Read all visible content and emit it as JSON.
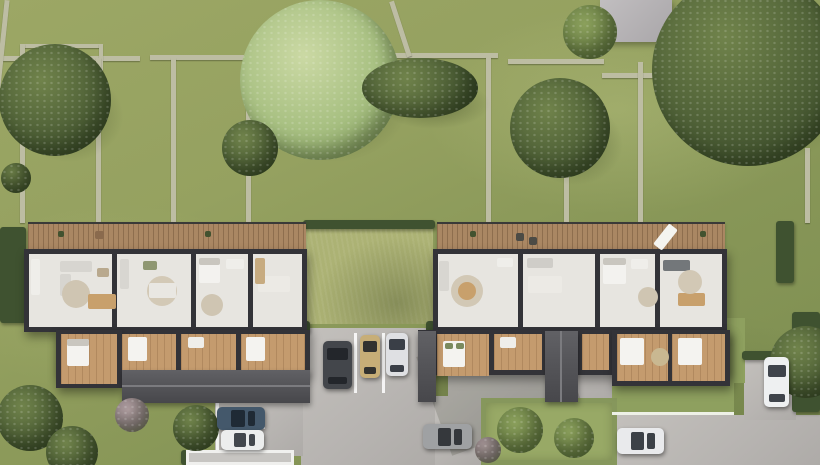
{
  "scene": {
    "canvas": {
      "width": 820,
      "height": 465
    },
    "palette": {
      "grass_base": "#8d9c5e",
      "grass_light": "#a3af6c",
      "courtyard_grass": "#acb274",
      "stone_wall": "#bdbda3",
      "hedge_dark": "#3f5230",
      "pavement": "#bab7b4",
      "deck_wood": "#aa8763",
      "building_wall": "#333338",
      "floor_light": "#e7e5e0",
      "floor_wood": "#c49b6e",
      "roof_gray": "#505054",
      "tree_dark": "#4a5c33",
      "tree_light": "#a9c183",
      "bed_white": "#f4f3f0",
      "table_tan": "#c8a06c"
    },
    "walls": [
      {
        "x": 0,
        "y": 56,
        "w": 140,
        "h": 5
      },
      {
        "x": 150,
        "y": 55,
        "w": 238,
        "h": 5
      },
      {
        "x": 392,
        "y": 53,
        "w": 106,
        "h": 5
      },
      {
        "x": 508,
        "y": 59,
        "w": 96,
        "h": 5
      },
      {
        "x": 602,
        "y": 73,
        "w": 60,
        "h": 5
      },
      {
        "x": 22,
        "y": 44,
        "w": 78,
        "h": 4
      },
      {
        "x": 99,
        "y": 44,
        "w": 4,
        "h": 64
      },
      {
        "x": 20,
        "y": 44,
        "w": 5,
        "h": 179
      },
      {
        "x": 96,
        "y": 58,
        "w": 5,
        "h": 165
      },
      {
        "x": 171,
        "y": 58,
        "w": 5,
        "h": 165
      },
      {
        "x": 246,
        "y": 58,
        "w": 5,
        "h": 165
      },
      {
        "x": 486,
        "y": 57,
        "w": 5,
        "h": 166
      },
      {
        "x": 564,
        "y": 108,
        "w": 5,
        "h": 115
      },
      {
        "x": 638,
        "y": 62,
        "w": 5,
        "h": 161
      },
      {
        "x": 805,
        "y": 148,
        "w": 5,
        "h": 75
      },
      {
        "x": 398,
        "y": 0,
        "w": 5,
        "h": 58,
        "rot": -18
      },
      {
        "x": 0,
        "y": 0,
        "w": 5,
        "h": 88,
        "rot": 6
      }
    ],
    "hedges": [
      {
        "x": 303,
        "y": 220,
        "w": 132,
        "h": 9
      },
      {
        "x": 0,
        "y": 227,
        "w": 26,
        "h": 96
      },
      {
        "x": 776,
        "y": 221,
        "w": 18,
        "h": 62
      },
      {
        "x": 742,
        "y": 351,
        "w": 52,
        "h": 9
      },
      {
        "x": 300,
        "y": 321,
        "w": 10,
        "h": 12
      },
      {
        "x": 426,
        "y": 321,
        "w": 9,
        "h": 12
      },
      {
        "x": 792,
        "y": 312,
        "w": 28,
        "h": 100
      },
      {
        "x": 181,
        "y": 450,
        "w": 7,
        "h": 15
      }
    ],
    "pavements": [
      {
        "x": 301,
        "y": 328,
        "w": 134,
        "h": 137
      },
      {
        "x": 215,
        "y": 401,
        "w": 88,
        "h": 55
      },
      {
        "x": 435,
        "y": 396,
        "w": 48,
        "h": 69
      },
      {
        "x": 448,
        "y": 372,
        "w": 164,
        "h": 28
      },
      {
        "x": 612,
        "y": 415,
        "w": 208,
        "h": 50
      },
      {
        "x": 744,
        "y": 357,
        "w": 52,
        "h": 63
      }
    ],
    "shades": [
      {
        "x": 430,
        "y": 330,
        "w": 140,
        "h": 105,
        "rot": -20
      }
    ],
    "grass_areas": [
      {
        "x": 305,
        "y": 228,
        "w": 128,
        "h": 96,
        "kind": "courtyard"
      },
      {
        "x": 612,
        "y": 383,
        "w": 122,
        "h": 32,
        "kind": "lawn"
      },
      {
        "x": 727,
        "y": 318,
        "w": 18,
        "h": 65,
        "kind": "lawn"
      },
      {
        "x": 481,
        "y": 398,
        "w": 136,
        "h": 67,
        "kind": "plot"
      }
    ],
    "markings": [
      {
        "x": 354,
        "y": 333,
        "w": 3,
        "h": 60
      },
      {
        "x": 382,
        "y": 333,
        "w": 3,
        "h": 60
      },
      {
        "x": 216,
        "y": 402,
        "w": 3,
        "h": 52
      },
      {
        "x": 217,
        "y": 427,
        "w": 48,
        "h": 2
      },
      {
        "x": 612,
        "y": 412,
        "w": 122,
        "h": 3
      }
    ],
    "structures": [
      {
        "x": 600,
        "y": 0,
        "w": 72,
        "h": 42,
        "kind": "flatroof",
        "name": "flat-roof-building"
      },
      {
        "x": 186,
        "y": 450,
        "w": 108,
        "h": 15,
        "kind": "canopy",
        "name": "carport-canopy"
      }
    ],
    "decks": [
      {
        "x": 28,
        "y": 222,
        "w": 278,
        "h": 29
      },
      {
        "x": 437,
        "y": 222,
        "w": 288,
        "h": 29
      }
    ],
    "blocks": [
      {
        "x": 24,
        "y": 249,
        "w": 283,
        "h": 83
      },
      {
        "x": 433,
        "y": 249,
        "w": 294,
        "h": 83
      },
      {
        "x": 56,
        "y": 330,
        "w": 254,
        "h": 45
      },
      {
        "x": 56,
        "y": 330,
        "w": 66,
        "h": 58
      },
      {
        "x": 418,
        "y": 330,
        "w": 312,
        "h": 45
      },
      {
        "x": 612,
        "y": 330,
        "w": 118,
        "h": 56
      }
    ],
    "rooms": [
      {
        "x": 29,
        "y": 254,
        "w": 83,
        "h": 73,
        "f": "light"
      },
      {
        "x": 117,
        "y": 254,
        "w": 74,
        "h": 73,
        "f": "light"
      },
      {
        "x": 196,
        "y": 254,
        "w": 52,
        "h": 73,
        "f": "light"
      },
      {
        "x": 253,
        "y": 254,
        "w": 49,
        "h": 73,
        "f": "light"
      },
      {
        "x": 438,
        "y": 254,
        "w": 80,
        "h": 73,
        "f": "light"
      },
      {
        "x": 523,
        "y": 254,
        "w": 72,
        "h": 73,
        "f": "light"
      },
      {
        "x": 600,
        "y": 254,
        "w": 55,
        "h": 73,
        "f": "light"
      },
      {
        "x": 660,
        "y": 254,
        "w": 62,
        "h": 73,
        "f": "light"
      },
      {
        "x": 61,
        "y": 334,
        "w": 56,
        "h": 50,
        "f": "wood"
      },
      {
        "x": 122,
        "y": 334,
        "w": 54,
        "h": 36,
        "f": "wood"
      },
      {
        "x": 181,
        "y": 334,
        "w": 55,
        "h": 36,
        "f": "wood"
      },
      {
        "x": 241,
        "y": 334,
        "w": 64,
        "h": 36,
        "f": "wood"
      },
      {
        "x": 437,
        "y": 334,
        "w": 52,
        "h": 42,
        "f": "wood"
      },
      {
        "x": 494,
        "y": 334,
        "w": 48,
        "h": 36,
        "f": "wood"
      },
      {
        "x": 582,
        "y": 334,
        "w": 27,
        "h": 36,
        "f": "wood"
      },
      {
        "x": 617,
        "y": 334,
        "w": 51,
        "h": 47,
        "f": "wood"
      },
      {
        "x": 672,
        "y": 334,
        "w": 53,
        "h": 47,
        "f": "wood"
      }
    ],
    "roofs": [
      {
        "x": 122,
        "y": 370,
        "w": 188,
        "h": 33
      },
      {
        "x": 418,
        "y": 331,
        "w": 18,
        "h": 71
      },
      {
        "x": 545,
        "y": 331,
        "w": 33,
        "h": 71
      },
      {
        "x": 122,
        "y": 385,
        "w": 188,
        "h": 2,
        "ridge": true
      },
      {
        "x": 560,
        "y": 331,
        "w": 2,
        "h": 71,
        "ridge": true
      }
    ],
    "furniture": [
      {
        "x": 31,
        "y": 259,
        "w": 9,
        "h": 36,
        "c": "#efeeea"
      },
      {
        "x": 60,
        "y": 261,
        "w": 32,
        "h": 11,
        "c": "#d7d5d0"
      },
      {
        "x": 60,
        "y": 274,
        "w": 11,
        "h": 22,
        "c": "#d7d5d0"
      },
      {
        "cx": 76,
        "cy": 294,
        "r": 14,
        "c": "#cfc5b2"
      },
      {
        "x": 88,
        "y": 294,
        "w": 28,
        "h": 15,
        "c": "#c8a06c"
      },
      {
        "x": 97,
        "y": 268,
        "w": 12,
        "h": 9,
        "c": "#b9a98e"
      },
      {
        "x": 120,
        "y": 259,
        "w": 9,
        "h": 30,
        "c": "#d8d6d1"
      },
      {
        "cx": 162,
        "cy": 291,
        "r": 15,
        "c": "#d3c9b6"
      },
      {
        "x": 149,
        "y": 283,
        "w": 27,
        "h": 15,
        "c": "#e9e7e2"
      },
      {
        "x": 143,
        "y": 261,
        "w": 14,
        "h": 9,
        "c": "#8f9772"
      },
      {
        "x": 199,
        "y": 258,
        "w": 21,
        "h": 25,
        "c": "#f3f2ef"
      },
      {
        "x": 199,
        "y": 258,
        "w": 21,
        "h": 7,
        "c": "#c9c6bf"
      },
      {
        "x": 226,
        "y": 259,
        "w": 18,
        "h": 10,
        "c": "#efeeea"
      },
      {
        "cx": 212,
        "cy": 305,
        "r": 11,
        "c": "#cfc5b2"
      },
      {
        "x": 258,
        "y": 276,
        "w": 32,
        "h": 16,
        "c": "#eceae5"
      },
      {
        "x": 255,
        "y": 258,
        "w": 10,
        "h": 26,
        "c": "#c7ab80"
      },
      {
        "x": 439,
        "y": 261,
        "w": 10,
        "h": 30,
        "c": "#d8d6d1"
      },
      {
        "cx": 467,
        "cy": 291,
        "r": 16,
        "c": "#d2c8b5"
      },
      {
        "cx": 467,
        "cy": 291,
        "r": 9,
        "c": "#c8a06c"
      },
      {
        "x": 497,
        "y": 258,
        "w": 16,
        "h": 9,
        "c": "#efeeea"
      },
      {
        "x": 527,
        "y": 258,
        "w": 26,
        "h": 10,
        "c": "#cfcdc8"
      },
      {
        "x": 528,
        "y": 276,
        "w": 34,
        "h": 17,
        "c": "#eceae5"
      },
      {
        "x": 603,
        "y": 258,
        "w": 23,
        "h": 26,
        "c": "#f3f2ef"
      },
      {
        "x": 603,
        "y": 258,
        "w": 23,
        "h": 7,
        "c": "#c9c6bf"
      },
      {
        "x": 631,
        "y": 259,
        "w": 17,
        "h": 10,
        "c": "#efeeea"
      },
      {
        "cx": 648,
        "cy": 297,
        "r": 10,
        "c": "#cfc5b2"
      },
      {
        "x": 663,
        "y": 260,
        "w": 27,
        "h": 11,
        "c": "#73777a"
      },
      {
        "x": 678,
        "y": 293,
        "w": 27,
        "h": 13,
        "c": "#c8a06c"
      },
      {
        "cx": 690,
        "cy": 282,
        "r": 12,
        "c": "#d2c8b5"
      },
      {
        "x": 67,
        "y": 339,
        "w": 22,
        "h": 27,
        "c": "#f4f3f0"
      },
      {
        "x": 67,
        "y": 339,
        "w": 22,
        "h": 7,
        "c": "#c9c6bf"
      },
      {
        "x": 128,
        "y": 337,
        "w": 19,
        "h": 24,
        "c": "#f4f3f0"
      },
      {
        "x": 188,
        "y": 337,
        "w": 16,
        "h": 11,
        "c": "#efeeea"
      },
      {
        "x": 246,
        "y": 337,
        "w": 19,
        "h": 24,
        "c": "#f4f3f0"
      },
      {
        "x": 443,
        "y": 341,
        "w": 22,
        "h": 26,
        "c": "#f4f3f0"
      },
      {
        "x": 445,
        "y": 343,
        "w": 8,
        "h": 6,
        "c": "#7a8a5f"
      },
      {
        "x": 456,
        "y": 343,
        "w": 8,
        "h": 6,
        "c": "#7a8a5f"
      },
      {
        "x": 500,
        "y": 337,
        "w": 16,
        "h": 11,
        "c": "#efeeea"
      },
      {
        "x": 620,
        "y": 338,
        "w": 24,
        "h": 27,
        "c": "#f4f3f0"
      },
      {
        "x": 678,
        "y": 338,
        "w": 24,
        "h": 27,
        "c": "#f4f3f0"
      },
      {
        "cx": 660,
        "cy": 357,
        "r": 9,
        "c": "#c9b891"
      },
      {
        "x": 516,
        "y": 233,
        "w": 8,
        "h": 8,
        "c": "#4c4b45"
      },
      {
        "x": 529,
        "y": 237,
        "w": 8,
        "h": 8,
        "c": "#4c4b45"
      },
      {
        "x": 660,
        "y": 224,
        "w": 11,
        "h": 26,
        "c": "#f4f4f0",
        "rot": 38
      },
      {
        "x": 95,
        "y": 231,
        "w": 9,
        "h": 8,
        "c": "#8a6a4d"
      },
      {
        "x": 58,
        "y": 231,
        "w": 6,
        "h": 6,
        "c": "#42522f"
      },
      {
        "x": 205,
        "y": 231,
        "w": 6,
        "h": 6,
        "c": "#42522f"
      },
      {
        "x": 470,
        "y": 231,
        "w": 6,
        "h": 6,
        "c": "#42522f"
      },
      {
        "x": 700,
        "y": 231,
        "w": 6,
        "h": 6,
        "c": "#42522f"
      }
    ],
    "trees": [
      {
        "cx": 55,
        "cy": 100,
        "r": 56,
        "tone": "dark"
      },
      {
        "cx": 320,
        "cy": 80,
        "r": 80,
        "tone": "light"
      },
      {
        "cx": 420,
        "cy": 88,
        "r": 58,
        "ry": 30,
        "tone": "dark"
      },
      {
        "cx": 560,
        "cy": 128,
        "r": 50,
        "tone": "dark"
      },
      {
        "cx": 590,
        "cy": 32,
        "r": 27,
        "tone": "mid"
      },
      {
        "cx": 748,
        "cy": 70,
        "r": 96,
        "tone": "dark"
      },
      {
        "cx": 250,
        "cy": 148,
        "r": 28,
        "tone": "dark"
      },
      {
        "cx": 16,
        "cy": 178,
        "r": 15,
        "tone": "dark"
      },
      {
        "cx": 30,
        "cy": 418,
        "r": 33,
        "tone": "dark"
      },
      {
        "cx": 72,
        "cy": 452,
        "r": 26,
        "tone": "dark"
      },
      {
        "cx": 196,
        "cy": 428,
        "r": 23,
        "tone": "dark"
      },
      {
        "cx": 806,
        "cy": 362,
        "r": 36,
        "tone": "dark"
      },
      {
        "cx": 520,
        "cy": 430,
        "r": 23,
        "tone": "mid"
      },
      {
        "cx": 574,
        "cy": 438,
        "r": 20,
        "tone": "mid"
      },
      {
        "cx": 132,
        "cy": 415,
        "r": 17,
        "tone": "pink"
      },
      {
        "cx": 488,
        "cy": 450,
        "r": 13,
        "tone": "pink"
      }
    ],
    "cars": [
      {
        "x": 323,
        "y": 341,
        "w": 29,
        "h": 48,
        "dir": "v",
        "body": "#43464b",
        "glass": "#23262b",
        "name": "car-dark-gray"
      },
      {
        "x": 360,
        "y": 335,
        "w": 20,
        "h": 43,
        "dir": "v",
        "body": "#c7ae77",
        "glass": "#32322f",
        "name": "car-tan"
      },
      {
        "x": 386,
        "y": 333,
        "w": 22,
        "h": 43,
        "dir": "v",
        "body": "#dfe0e3",
        "glass": "#3a3f47",
        "name": "car-silver"
      },
      {
        "x": 217,
        "y": 407,
        "w": 48,
        "h": 23,
        "dir": "h",
        "body": "#44586b",
        "glass": "#1f2a35",
        "name": "car-blue"
      },
      {
        "x": 221,
        "y": 430,
        "w": 43,
        "h": 20,
        "dir": "h",
        "body": "#eceded",
        "glass": "#43474d",
        "name": "car-white-bay"
      },
      {
        "x": 423,
        "y": 424,
        "w": 49,
        "h": 25,
        "dir": "h",
        "body": "#9fa1a3",
        "glass": "#35383c",
        "name": "car-gray"
      },
      {
        "x": 617,
        "y": 428,
        "w": 47,
        "h": 26,
        "dir": "h",
        "body": "#e9eaec",
        "glass": "#3c4147",
        "name": "car-white-bottom"
      },
      {
        "x": 764,
        "y": 357,
        "w": 25,
        "h": 50,
        "dir": "v",
        "body": "#eef0f1",
        "glass": "#3f444b",
        "name": "car-white-right"
      }
    ]
  }
}
